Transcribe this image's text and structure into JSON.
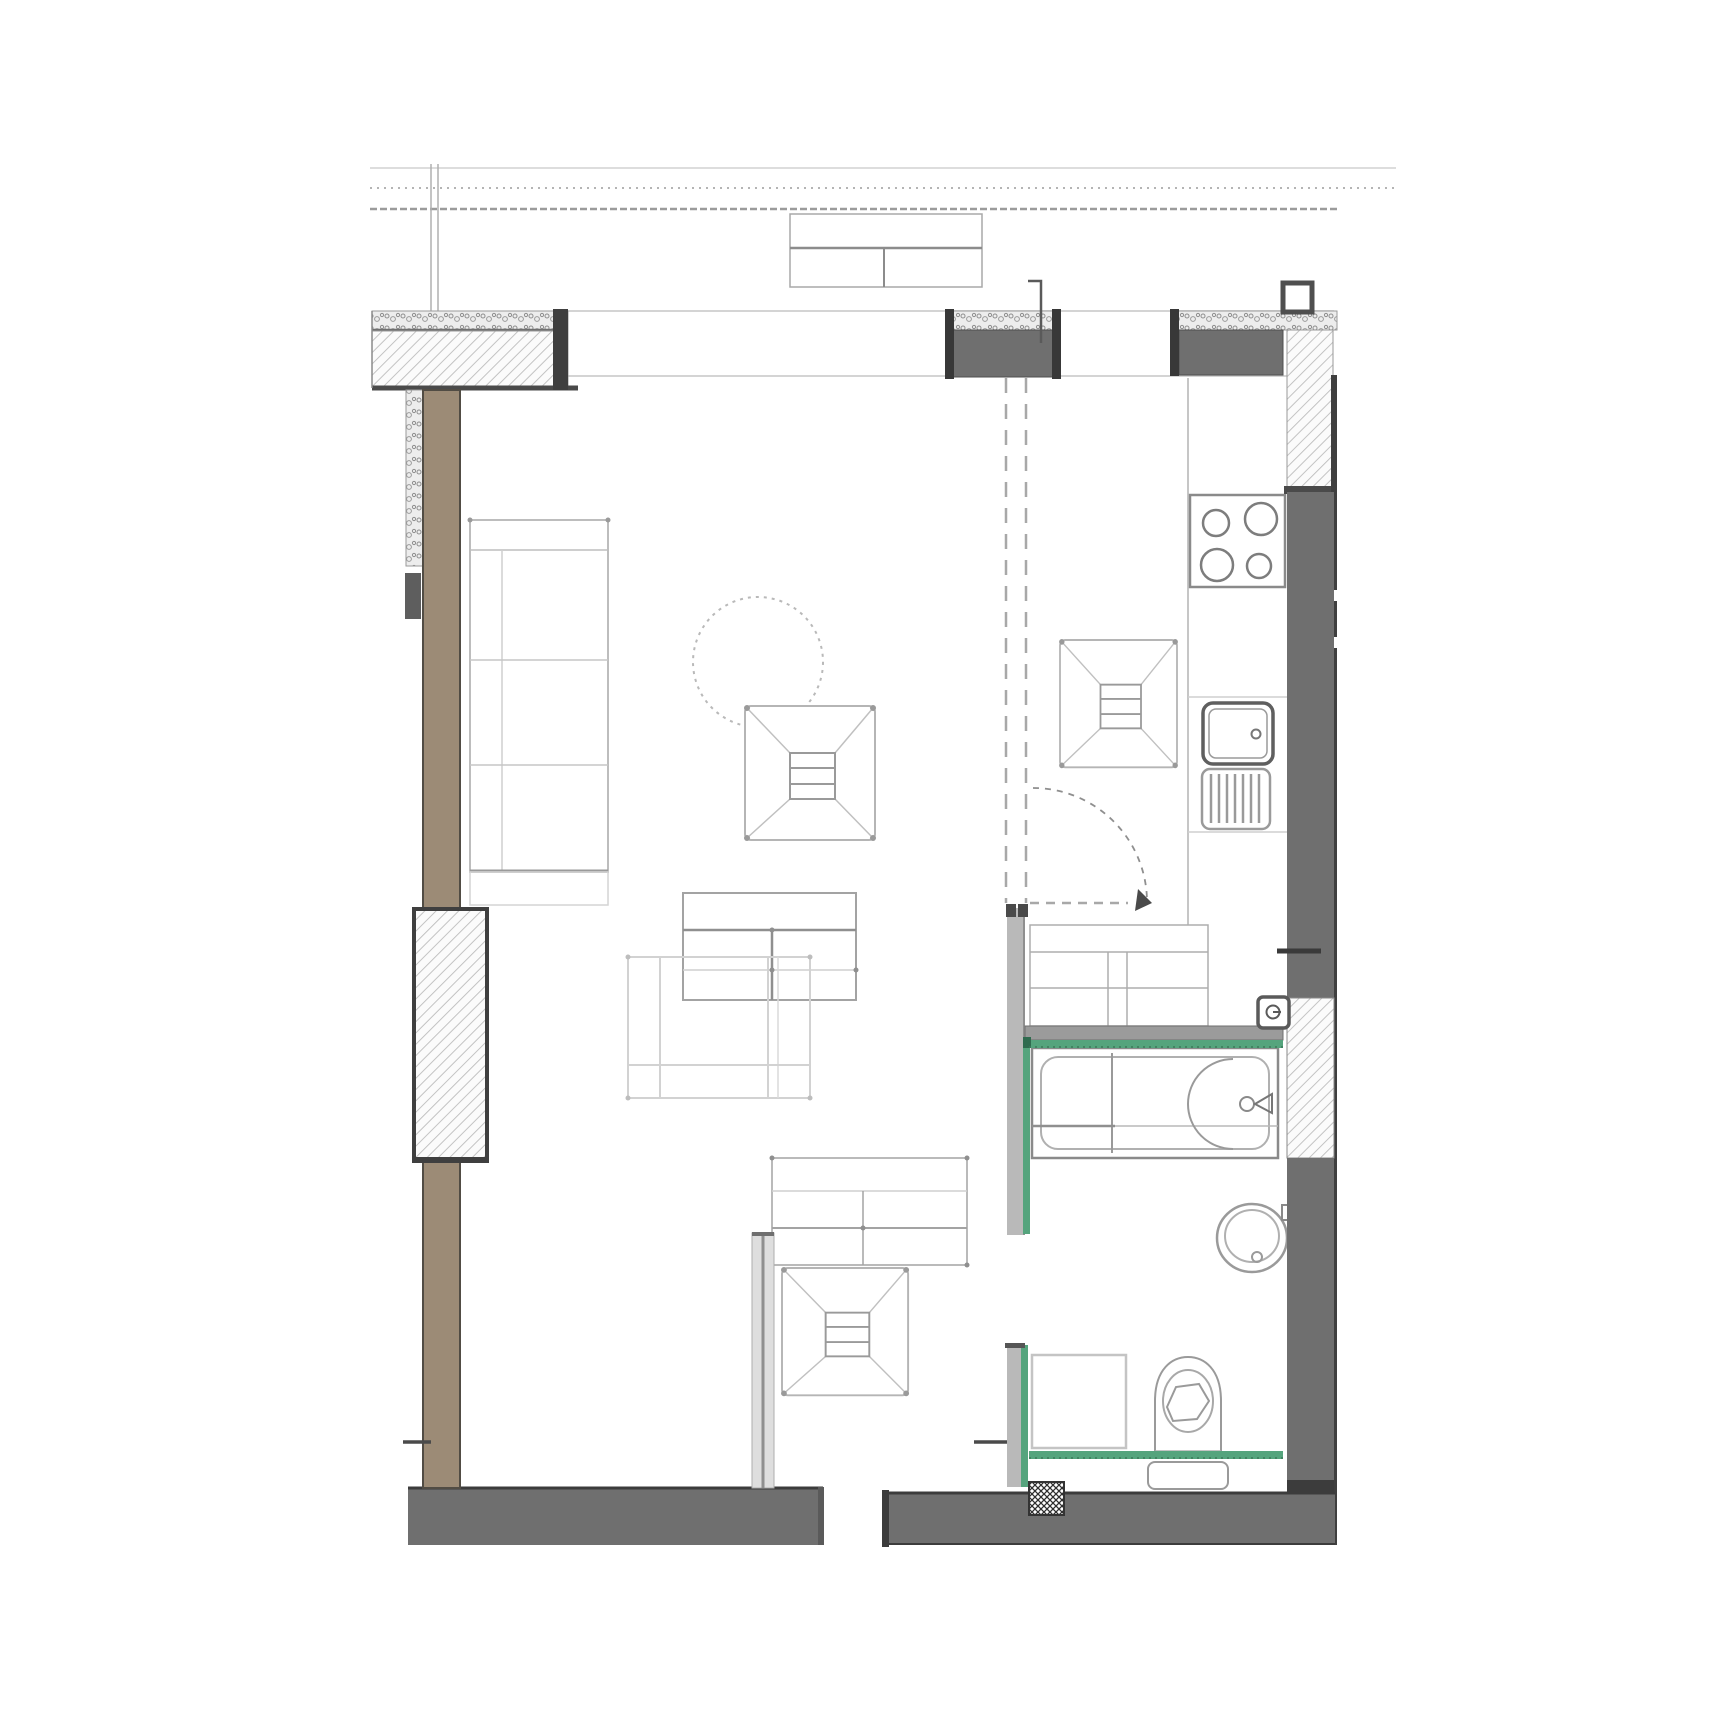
{
  "document": {
    "kind": "architectural-floor-plan",
    "visible_text": []
  },
  "colors": {
    "accent_green": "#55a47d",
    "accent_green_dark": "#2f6b4f",
    "wall_dark": "#6f6f6f",
    "wall_mid": "#b9b9b9",
    "wall_cap": "#3c3c3c",
    "wood_brown": "#9c8b76",
    "wood_edge": "#514c44",
    "line_light": "#cfcfcf",
    "line_mid": "#9a9a9a",
    "line_dark": "#555555",
    "paper": "#ffffff"
  },
  "elements": [
    "dimension-lines",
    "balcony-table",
    "window-band",
    "exterior-wall-top-left",
    "pillar-top-1",
    "pillar-top-2",
    "pillar-hatched-right",
    "wall-right-kitchen",
    "wall-right-bath-hatch",
    "wall-right-lower",
    "outer-wall-right-edge",
    "wall-left-wood",
    "wall-left-hatch-block",
    "wall-bottom-left",
    "wall-bottom-right",
    "partition-bottom-center",
    "bath-partition-upper",
    "bath-wall-top",
    "bath-partition-lower",
    "sofa",
    "round-table",
    "armchair-living",
    "armchair-kitchen",
    "armchair-desk",
    "coffee-table",
    "side-table",
    "desk",
    "hall-dresser",
    "kitchen-counter",
    "cooktop-icon",
    "sink-icon",
    "drainboard-icon",
    "door-swing-icon",
    "bathtub-icon",
    "washbasin-icon",
    "toilet-icon",
    "cistern",
    "switch-icon",
    "floor-drain-crosshatch"
  ]
}
